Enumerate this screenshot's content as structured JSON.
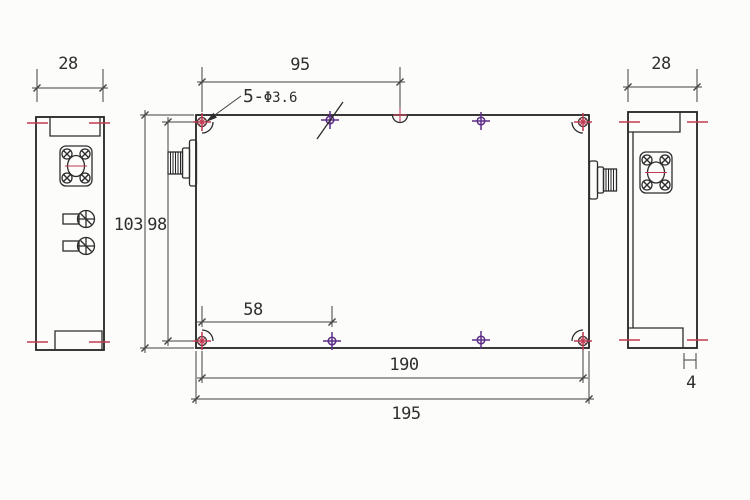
{
  "drawing": {
    "labels": {
      "left_view_width": "28",
      "right_view_width": "28",
      "top_hole_span": "95",
      "hole_callout_prefix": "5-",
      "hole_callout_size": "Φ3.6",
      "height_overall": "103",
      "height_between_holes": "98",
      "bottom_hole_offset": "58",
      "hole_span_width": "190",
      "width_overall": "195",
      "flange_lip_width": "4"
    },
    "colors": {
      "line": "#2c2c2c",
      "center_mark_red": "#c13b52",
      "hole_mark_purple": "#5c2d87",
      "background": "#fcfcfb"
    },
    "icons": {
      "corner_screw": "screw-hole-crosshair-icon",
      "edge_screw": "screw-hole-purple-icon",
      "edge_notch": "half-hole-notch-icon",
      "rf_flange": "rf-connector-flange-icon",
      "rf_coax": "coax-connector-icon",
      "terminal": "feedthrough-terminal-icon",
      "center_mark": "centerline-dash-icon"
    }
  }
}
